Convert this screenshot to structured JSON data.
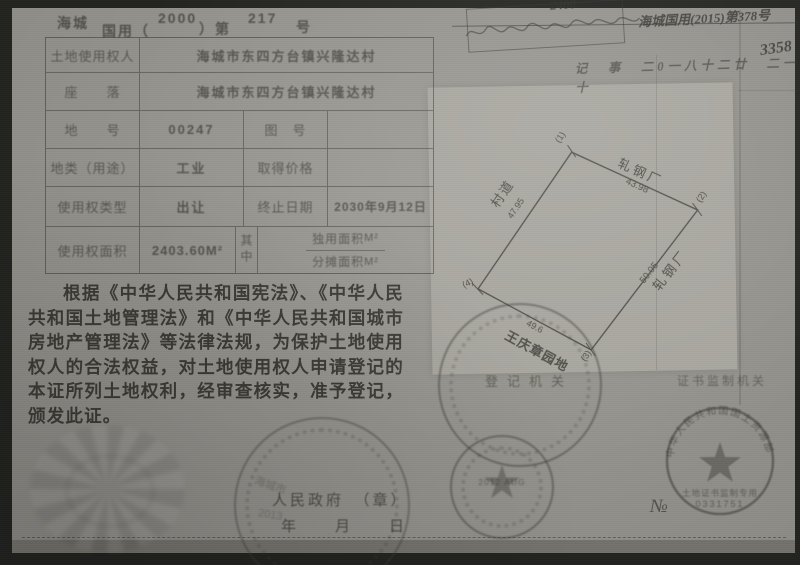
{
  "colors": {
    "paper": "#94928c",
    "ink": "#3c3c37",
    "panel": "#a7a59e",
    "scan_border": "#22221f"
  },
  "header": {
    "region": "海城",
    "type_label": "国用（",
    "year": "2000",
    "mid_label": "）第",
    "serial": "217",
    "suffix": "号"
  },
  "table": {
    "r1_label": "土地使用权人",
    "r1_value": "海城市东四方台镇兴隆达村",
    "r2_label": "座　　落",
    "r2_value": "海城市东四方台镇兴隆达村",
    "r3_label": "地　　号",
    "r3_value": "00247",
    "r3_label2": "图　号",
    "r3_value2": "",
    "r4_label": "地类（用途）",
    "r4_value": "工业",
    "r4_label2": "取得价格",
    "r4_value2": "",
    "r5_label": "使用权类型",
    "r5_value": "出让",
    "r5_label2": "终止日期",
    "r5_value2": "2030年9月12日",
    "r6_label": "使用权面积",
    "r6_value": "2403.60M²",
    "r6_mid": "其中",
    "r6_sub1_label": "独用面积",
    "r6_sub1_unit": "M²",
    "r6_sub2_label": "分摊面积",
    "r6_sub2_unit": "M²"
  },
  "body_text": "根据《中华人民共和国宪法》、《中华人民共和国土地管理法》和《中华人民共和国城市房地产管理法》等法律法规，为保护土地使用权人的合法权益，对土地使用权人申请登记的本证所列土地权利，经审查核实，准予登记，颁发此证。",
  "footer": {
    "government": "人民政府　（章）",
    "date_blanks": "年　　月　　日",
    "registration_label": "登记机关",
    "supervision_label": "证书监制机关"
  },
  "diagram": {
    "corner1": "(1)",
    "corner2": "(2)",
    "corner3": "(3)",
    "corner4": "(4)",
    "edge_top_name": "轧钢厂",
    "edge_top_len": "43.98",
    "edge_right_name": "轧钢厂",
    "edge_right_len": "50.05",
    "edge_bottom_name": "王庆章园地",
    "edge_bottom_len": "49.6",
    "edge_left_name": "村道",
    "edge_left_len": "47.95"
  },
  "stamps": {
    "ministry_rim": "中华人民共和国国土资源部",
    "ministry_inner": "土地证书监制专用",
    "ministry_serial": "0331751",
    "no_symbol": "№",
    "date_stamp": "2012 AUG",
    "gov_stamp_city": "海城市",
    "gov_stamp_year": "2013",
    "star": "★"
  },
  "annotations": {
    "box_number": "2400",
    "cert_update": "海城国用(2015)第378号",
    "big_number": "3358",
    "note_line": "记　事　二0一八十二廿　二一十"
  }
}
